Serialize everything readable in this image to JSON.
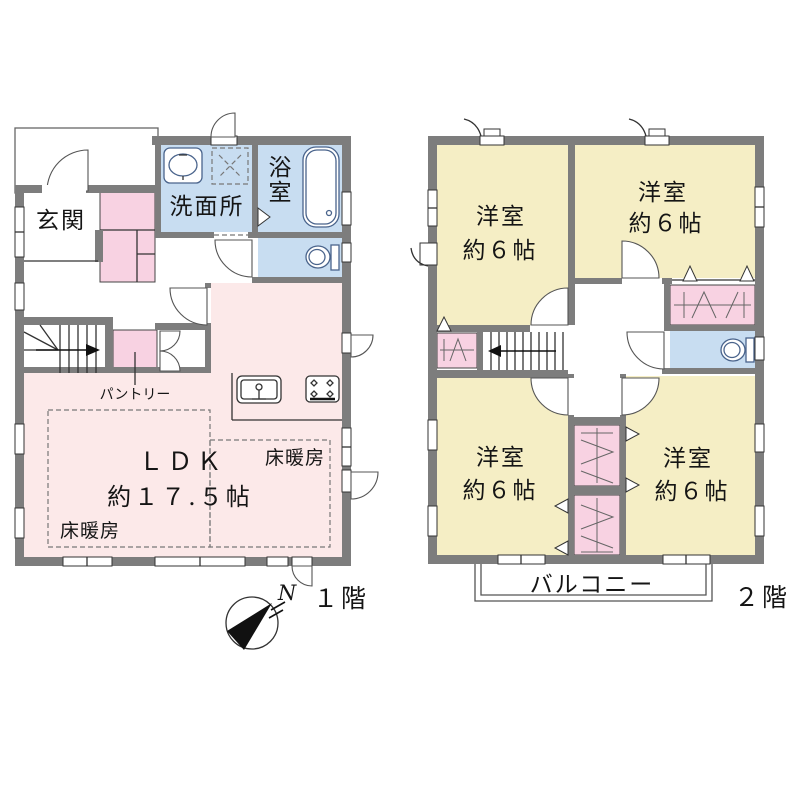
{
  "title": "間取り図",
  "colors": {
    "wall_gray": "#7d7d7d",
    "bedroom_yellow": "#f5eec5",
    "ldk_pink": "#fce9e9",
    "closet_pink": "#f8d2e2",
    "wet_area_blue": "#c8ddf1",
    "line_black": "#333333"
  },
  "compass": {
    "north": "N"
  },
  "floor1": {
    "floor_label": "１階",
    "entrance": "玄関",
    "washroom": "洗面所",
    "bath": "浴室",
    "ldk_title": "ＬＤＫ",
    "ldk_area": "約１７.５帖",
    "floor_heating_right": "床暖房",
    "floor_heating_left": "床暖房",
    "pantry": "パントリー"
  },
  "floor2": {
    "floor_label": "２階",
    "bedroom_tl": {
      "name": "洋室",
      "area": "約６帖"
    },
    "bedroom_tr": {
      "name": "洋室",
      "area": "約６帖"
    },
    "bedroom_bl": {
      "name": "洋室",
      "area": "約６帖"
    },
    "bedroom_br": {
      "name": "洋室",
      "area": "約６帖"
    },
    "balcony": "バルコニー"
  },
  "icons": [
    "bathtub-icon",
    "toilet-icon",
    "sink-icon",
    "washer-pan-icon",
    "kitchen-sink-icon",
    "stove-icon",
    "stairs-arrow-icon",
    "compass-icon"
  ]
}
